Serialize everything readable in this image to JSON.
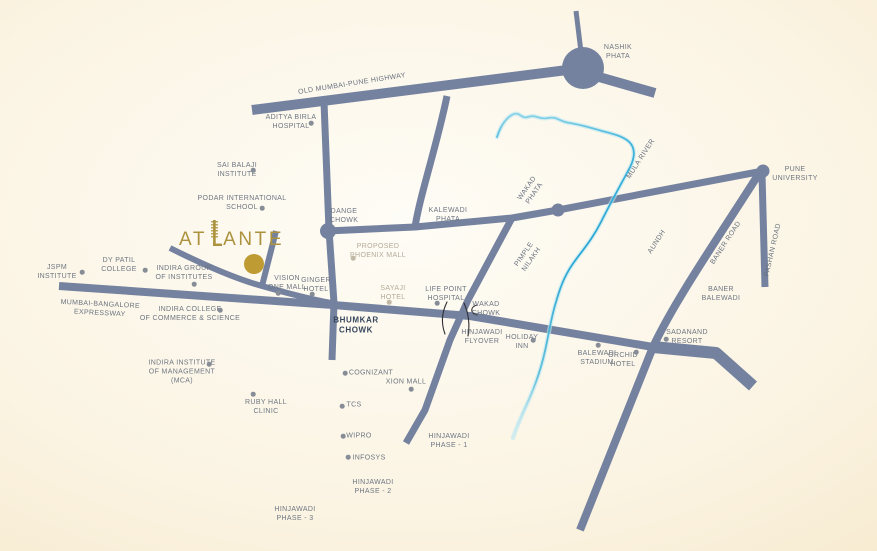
{
  "map": {
    "title": "Atlante location map",
    "brand": {
      "name": "ATLANTE",
      "text_before_tower": "AT",
      "text_after_tower": "ANTE",
      "logo_color": "#AC923C",
      "marker_color": "#BE9B33"
    },
    "colors": {
      "road": "#75829F",
      "road_label": "#68717E",
      "poi_text": "#6E7682",
      "poi_text_light": "#B5AB97",
      "poi_dot": "#878D97",
      "poi_dot_light": "#C1B8A6",
      "bold_text": "#36455C",
      "flyover_mark": "#2F2F33",
      "river_main": "#2BA7D3",
      "river_halo": "#BCE8F2",
      "bg_center": "#FEFCF6",
      "bg_edge": "#F1DFBC"
    },
    "roads": [
      {
        "id": "old-mumbai-pune-highway",
        "d": "M252,110 L583,68",
        "w": 10
      },
      {
        "id": "nashik-phata-north-stub",
        "d": "M576,11 L582,60",
        "w": 5
      },
      {
        "id": "nashik-phata-east-stub",
        "d": "M592,75 L655,93",
        "w": 10
      },
      {
        "id": "dange-chowk-road",
        "d": "M324,102 L329,230 L334,303 L332,360",
        "w": 7
      },
      {
        "id": "dange-to-pune-university-road",
        "d": "M327,231 L415,227 L512,218 L558,210 L763,171",
        "w": 7
      },
      {
        "id": "kalewadi-branch",
        "d": "M447,96 C437,145 420,195 415,227",
        "w": 7
      },
      {
        "id": "hinjawadi-road",
        "d": "M512,218 L468,300 L450,340 L425,410 L406,443",
        "w": 7
      },
      {
        "id": "mumbai-bangalore-expressway",
        "d": "M59,286 L333,305 L470,316 L653,347 L714,353",
        "w": 8
      },
      {
        "id": "baner-balewadi-stub",
        "d": "M653,347 L716,353 L753,386",
        "w": 12
      },
      {
        "id": "baner-road",
        "d": "M760,172 C720,235 675,300 653,347 L580,530",
        "w": 8
      },
      {
        "id": "pashan-road",
        "d": "M762,174 L765,287",
        "w": 7
      },
      {
        "id": "atlante-access-road",
        "d": "M170,248 C210,268 240,280 262,286 C290,294 315,300 331,303",
        "w": 6
      },
      {
        "id": "atlante-access-stub",
        "d": "M276,231 L262,286",
        "w": 6
      }
    ],
    "junctions": [
      {
        "id": "nashik-phata",
        "x": 583,
        "y": 68,
        "r": 21
      },
      {
        "id": "dange-chowk",
        "x": 328,
        "y": 231,
        "r": 8
      },
      {
        "id": "wakad-phata",
        "x": 558,
        "y": 210,
        "r": 6.5
      },
      {
        "id": "pune-university",
        "x": 763,
        "y": 171,
        "r": 6.5
      }
    ],
    "river": {
      "name": "Mula River",
      "d": "M497,137 C501,124 508,116 514,114 C520,112 521,119 528,117 C536,114 539,120 548,118 C557,116 560,122 570,123 C582,125 592,128 602,131 C614,134 626,137 631,144 C636,151 634,161 628,171 C620,186 610,204 601,222 C592,240 581,252 572,265 C564,277 560,288 556,302 C551,318 549,333 545,351 C541,369 536,383 530,397 C524,411 517,425 513,438",
      "gradient": [
        {
          "o": 0,
          "c": "#8AD4E8",
          "a": 0.9
        },
        {
          "o": 0.12,
          "c": "#3FB2DA",
          "a": 1
        },
        {
          "o": 0.45,
          "c": "#2BA7D3",
          "a": 1
        },
        {
          "o": 0.8,
          "c": "#55BBDA",
          "a": 0.9
        },
        {
          "o": 1,
          "c": "#CFEFF7",
          "a": 0.15
        }
      ]
    },
    "flyover_marks": [
      "M447,302 Q439,318 445,334",
      "M464,303 Q471,319 468,336",
      "M477,305 C470,307 470,313 477,315"
    ],
    "labels": [
      {
        "id": "jspm-institute",
        "lines": [
          "JSPM",
          "INSTITUTE"
        ],
        "x": 57,
        "y": 272,
        "dot": {
          "x": 82,
          "y": 272
        }
      },
      {
        "id": "dy-patil-college",
        "lines": [
          "DY PATIL",
          "COLLEGE"
        ],
        "x": 119,
        "y": 265,
        "dot": {
          "x": 145,
          "y": 270
        }
      },
      {
        "id": "indira-group-of-institutes",
        "lines": [
          "INDIRA GROUP",
          "OF INSTITUTES"
        ],
        "x": 184,
        "y": 273,
        "dot": {
          "x": 194,
          "y": 284
        }
      },
      {
        "id": "sai-balaji-institute",
        "lines": [
          "SAI BALAJI",
          "INSTITUTE"
        ],
        "x": 237,
        "y": 170,
        "dot": {
          "x": 253,
          "y": 170
        }
      },
      {
        "id": "podar-international-school",
        "lines": [
          "PODAR INTERNATIONAL",
          "SCHOOL"
        ],
        "x": 242,
        "y": 203,
        "dot": {
          "x": 262,
          "y": 208
        }
      },
      {
        "id": "aditya-birla-hospital",
        "lines": [
          "ADITYA BIRLA",
          "HOSPITAL"
        ],
        "x": 291,
        "y": 122,
        "dot": {
          "x": 311,
          "y": 123
        }
      },
      {
        "id": "vision-one-mall",
        "lines": [
          "VISION",
          "ONE MALL"
        ],
        "x": 287,
        "y": 283,
        "dot": {
          "x": 278,
          "y": 293
        }
      },
      {
        "id": "ginger-hotel",
        "lines": [
          "GINGER",
          "HOTEL"
        ],
        "x": 316,
        "y": 285,
        "dot": {
          "x": 312,
          "y": 294
        }
      },
      {
        "id": "sayaji-hotel",
        "lines": [
          "SAYAJI",
          "HOTEL"
        ],
        "x": 393,
        "y": 293,
        "style": "light",
        "dot": {
          "x": 389,
          "y": 302
        }
      },
      {
        "id": "life-point-hospital",
        "lines": [
          "LIFE POINT",
          "HOSPITAL"
        ],
        "x": 446,
        "y": 294,
        "dot": {
          "x": 437,
          "y": 303
        }
      },
      {
        "id": "proposed-phoenix-mall",
        "lines": [
          "PROPOSED",
          "PHOENIX MALL"
        ],
        "x": 378,
        "y": 251,
        "style": "light",
        "dot": {
          "x": 353,
          "y": 258
        }
      },
      {
        "id": "cognizant",
        "lines": [
          "COGNIZANT"
        ],
        "x": 371,
        "y": 373,
        "dot": {
          "x": 345,
          "y": 373
        }
      },
      {
        "id": "xion-mall",
        "lines": [
          "XION MALL"
        ],
        "x": 406,
        "y": 382,
        "dot": {
          "x": 411,
          "y": 389
        }
      },
      {
        "id": "tcs",
        "lines": [
          "TCS"
        ],
        "x": 354,
        "y": 405,
        "dot": {
          "x": 342,
          "y": 406
        }
      },
      {
        "id": "wipro",
        "lines": [
          "WIPRO"
        ],
        "x": 359,
        "y": 436,
        "dot": {
          "x": 343,
          "y": 436
        }
      },
      {
        "id": "infosys",
        "lines": [
          "INFOSYS"
        ],
        "x": 369,
        "y": 458,
        "dot": {
          "x": 348,
          "y": 457
        }
      },
      {
        "id": "ruby-hall-clinic",
        "lines": [
          "RUBY HALL",
          "CLINIC"
        ],
        "x": 266,
        "y": 407,
        "dot": {
          "x": 253,
          "y": 394
        }
      },
      {
        "id": "holiday-inn",
        "lines": [
          "HOLIDAY",
          "INN"
        ],
        "x": 522,
        "y": 342,
        "dot": {
          "x": 533,
          "y": 340
        }
      },
      {
        "id": "balewadi-stadium",
        "lines": [
          "BALEWADI",
          "STADIUM"
        ],
        "x": 597,
        "y": 358,
        "dot": {
          "x": 598,
          "y": 345
        }
      },
      {
        "id": "orchid-hotel",
        "lines": [
          "ORCHID",
          "HOTEL"
        ],
        "x": 623,
        "y": 360,
        "dot": {
          "x": 636,
          "y": 352
        }
      },
      {
        "id": "sadanand-resort",
        "lines": [
          "SADANAND",
          "RESORT"
        ],
        "x": 687,
        "y": 337,
        "dot": {
          "x": 666,
          "y": 339
        }
      },
      {
        "id": "baner-balewadi",
        "lines": [
          "BANER",
          "BALEWADI"
        ],
        "x": 721,
        "y": 294
      },
      {
        "id": "hinjawadi-phase-1",
        "lines": [
          "HINJAWADI",
          "PHASE - 1"
        ],
        "x": 449,
        "y": 441
      },
      {
        "id": "hinjawadi-phase-2",
        "lines": [
          "HINJAWADI",
          "PHASE - 2"
        ],
        "x": 373,
        "y": 487
      },
      {
        "id": "hinjawadi-phase-3",
        "lines": [
          "HINJAWADI",
          "PHASE - 3"
        ],
        "x": 295,
        "y": 514
      },
      {
        "id": "nashik-phata",
        "lines": [
          "NASHIK",
          "PHATA"
        ],
        "x": 618,
        "y": 52
      },
      {
        "id": "pune-university",
        "lines": [
          "PUNE",
          "UNIVERSITY"
        ],
        "x": 795,
        "y": 174
      },
      {
        "id": "kalewadi-phata",
        "lines": [
          "KALEWADI",
          "PHATA"
        ],
        "x": 448,
        "y": 215
      },
      {
        "id": "dange-chowk",
        "lines": [
          "DANGE",
          "CHOWK"
        ],
        "x": 344,
        "y": 216
      },
      {
        "id": "wakad-chowk",
        "lines": [
          "WAKAD",
          "CHOWK"
        ],
        "x": 486,
        "y": 309
      },
      {
        "id": "hinjawadi-flyover",
        "lines": [
          "HINJAWADI",
          "FLYOVER"
        ],
        "x": 482,
        "y": 337
      },
      {
        "id": "bhumkar-chowk",
        "lines": [
          "BHUMKAR",
          "CHOWK"
        ],
        "x": 356,
        "y": 326,
        "style": "bold"
      },
      {
        "id": "indira-college-of-commerce",
        "lines": [
          "INDIRA COLLEGE",
          "OF COMMERCE & SCIENCE"
        ],
        "x": 190,
        "y": 314,
        "dot": {
          "x": 220,
          "y": 310
        }
      },
      {
        "id": "indira-institute-of-management",
        "lines": [
          "INDIRA INSTITUTE",
          "OF MANAGEMENT",
          "(MCA)"
        ],
        "x": 182,
        "y": 372,
        "dot": {
          "x": 209,
          "y": 364
        }
      },
      {
        "id": "mumbai-bangalore-expressway",
        "lines": [
          "MUMBAI-BANGALORE",
          "EXPRESSWAY"
        ],
        "x": 100,
        "y": 309,
        "rot": 3,
        "style": "roadname"
      },
      {
        "id": "old-mumbai-pune-highway",
        "lines": [
          "OLD MUMBAI-PUNE HIGHWAY"
        ],
        "x": 352,
        "y": 84,
        "rot": -9,
        "style": "roadname"
      },
      {
        "id": "wakad-phata",
        "lines": [
          "WAKAD",
          "PHATA"
        ],
        "x": 531,
        "y": 191,
        "rot": -55,
        "style": "roadname"
      },
      {
        "id": "pimple-nilakh",
        "lines": [
          "PIMPLE",
          "NILAKH"
        ],
        "x": 528,
        "y": 257,
        "rot": -55,
        "style": "roadname"
      },
      {
        "id": "mula-river",
        "lines": [
          "MULA RIVER"
        ],
        "x": 641,
        "y": 159,
        "rot": -57,
        "style": "roadname"
      },
      {
        "id": "aundh",
        "lines": [
          "AUNDH"
        ],
        "x": 657,
        "y": 242,
        "rot": -57,
        "style": "roadname"
      },
      {
        "id": "baner-road",
        "lines": [
          "BANER ROAD"
        ],
        "x": 726,
        "y": 243,
        "rot": -57,
        "style": "roadname"
      },
      {
        "id": "pashan-road",
        "lines": [
          "PASHAN ROAD"
        ],
        "x": 773,
        "y": 250,
        "rot": -77,
        "style": "roadname"
      }
    ]
  }
}
